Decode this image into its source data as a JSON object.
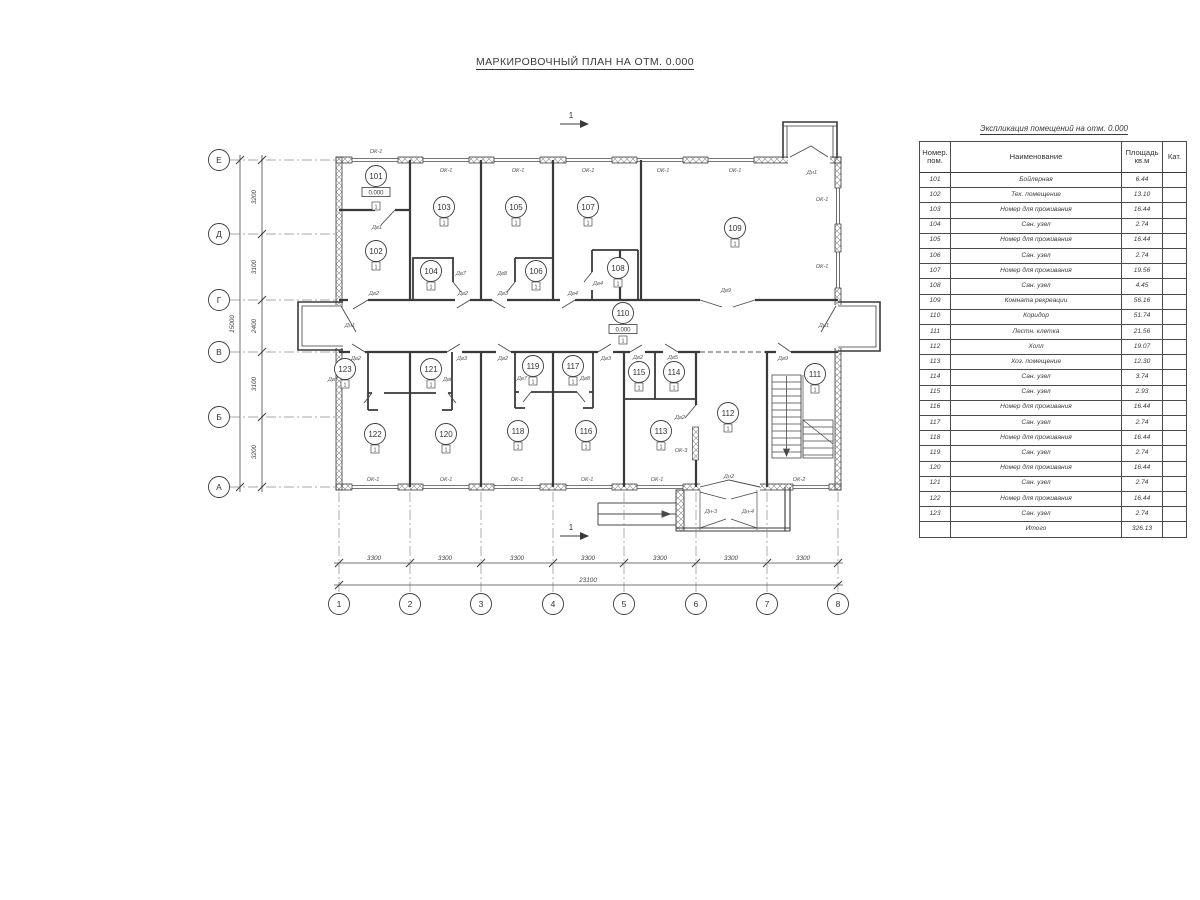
{
  "title": "МАРКИРОВОЧНЫЙ ПЛАН НА ОТМ. 0.000",
  "table": {
    "title": "Экспликация помещений на отм. 0.000",
    "headers": {
      "num": "Номер.\nпом.",
      "name": "Наименование",
      "area": "Площадь\nкв.м",
      "cat": "Кат."
    },
    "rows": [
      {
        "num": "101",
        "name": "Бойлерная",
        "area": "6.44"
      },
      {
        "num": "102",
        "name": "Тех. помещение",
        "area": "13.10"
      },
      {
        "num": "103",
        "name": "Номер для проживания",
        "area": "16.44"
      },
      {
        "num": "104",
        "name": "Сан. узел",
        "area": "2.74"
      },
      {
        "num": "105",
        "name": "Номер для проживания",
        "area": "16.44"
      },
      {
        "num": "106",
        "name": "Сан. узел",
        "area": "2.74"
      },
      {
        "num": "107",
        "name": "Номер для проживания",
        "area": "19.56"
      },
      {
        "num": "108",
        "name": "Сан. узел",
        "area": "4.45"
      },
      {
        "num": "109",
        "name": "Комната рекреации",
        "area": "56.16"
      },
      {
        "num": "110",
        "name": "Коридор",
        "area": "51.74"
      },
      {
        "num": "111",
        "name": "Лестн. клетка",
        "area": "21.56"
      },
      {
        "num": "112",
        "name": "Холл",
        "area": "19.07"
      },
      {
        "num": "113",
        "name": "Хоз. помещение",
        "area": "12.30"
      },
      {
        "num": "114",
        "name": "Сан. узел",
        "area": "3.74"
      },
      {
        "num": "115",
        "name": "Сан. узел",
        "area": "2.93"
      },
      {
        "num": "116",
        "name": "Номер для проживания",
        "area": "16.44"
      },
      {
        "num": "117",
        "name": "Сан. узел",
        "area": "2.74"
      },
      {
        "num": "118",
        "name": "Номер для проживания",
        "area": "16.44"
      },
      {
        "num": "119",
        "name": "Сан. узел",
        "area": "2.74"
      },
      {
        "num": "120",
        "name": "Номер для проживания",
        "area": "16.44"
      },
      {
        "num": "121",
        "name": "Сан. узел",
        "area": "2.74"
      },
      {
        "num": "122",
        "name": "Номер для проживания",
        "area": "16.44"
      },
      {
        "num": "123",
        "name": "Сан. узел",
        "area": "2.74"
      }
    ],
    "total_label": "Итого",
    "total_value": "326.13"
  },
  "plan": {
    "level_mark": "0.000",
    "floor_type_mark": "1",
    "section_mark": "1",
    "room_numbers": [
      "101",
      "102",
      "103",
      "104",
      "105",
      "106",
      "107",
      "108",
      "109",
      "110",
      "111",
      "112",
      "113",
      "114",
      "115",
      "116",
      "117",
      "118",
      "119",
      "120",
      "121",
      "122",
      "123"
    ],
    "axis_rows": [
      "Е",
      "Д",
      "Г",
      "В",
      "Б",
      "А"
    ],
    "axis_cols": [
      "1",
      "2",
      "3",
      "4",
      "5",
      "6",
      "7",
      "8"
    ],
    "dim_left": [
      "3200",
      "3100",
      "2400",
      "3100",
      "3200"
    ],
    "dim_left_total": "15000",
    "dim_bottom": [
      "3300",
      "3300",
      "3300",
      "3300",
      "3300",
      "3300",
      "3300"
    ],
    "dim_bottom_total": "23100",
    "tags": {
      "ok1": "ОК-1",
      "ok2": "ОК-2",
      "ok3": "ОК-3",
      "dv1": "Дв1",
      "dv2": "Дв2",
      "dv3": "Дв3",
      "dv4": "Дв4",
      "dv5": "Дв5",
      "dv7": "Дв7",
      "dv8": "Дв8",
      "dv9": "Дв9",
      "dn1": "Дн1",
      "dn2": "Дн2",
      "dn3": "Дн-3",
      "dn4": "Дн-4"
    }
  }
}
